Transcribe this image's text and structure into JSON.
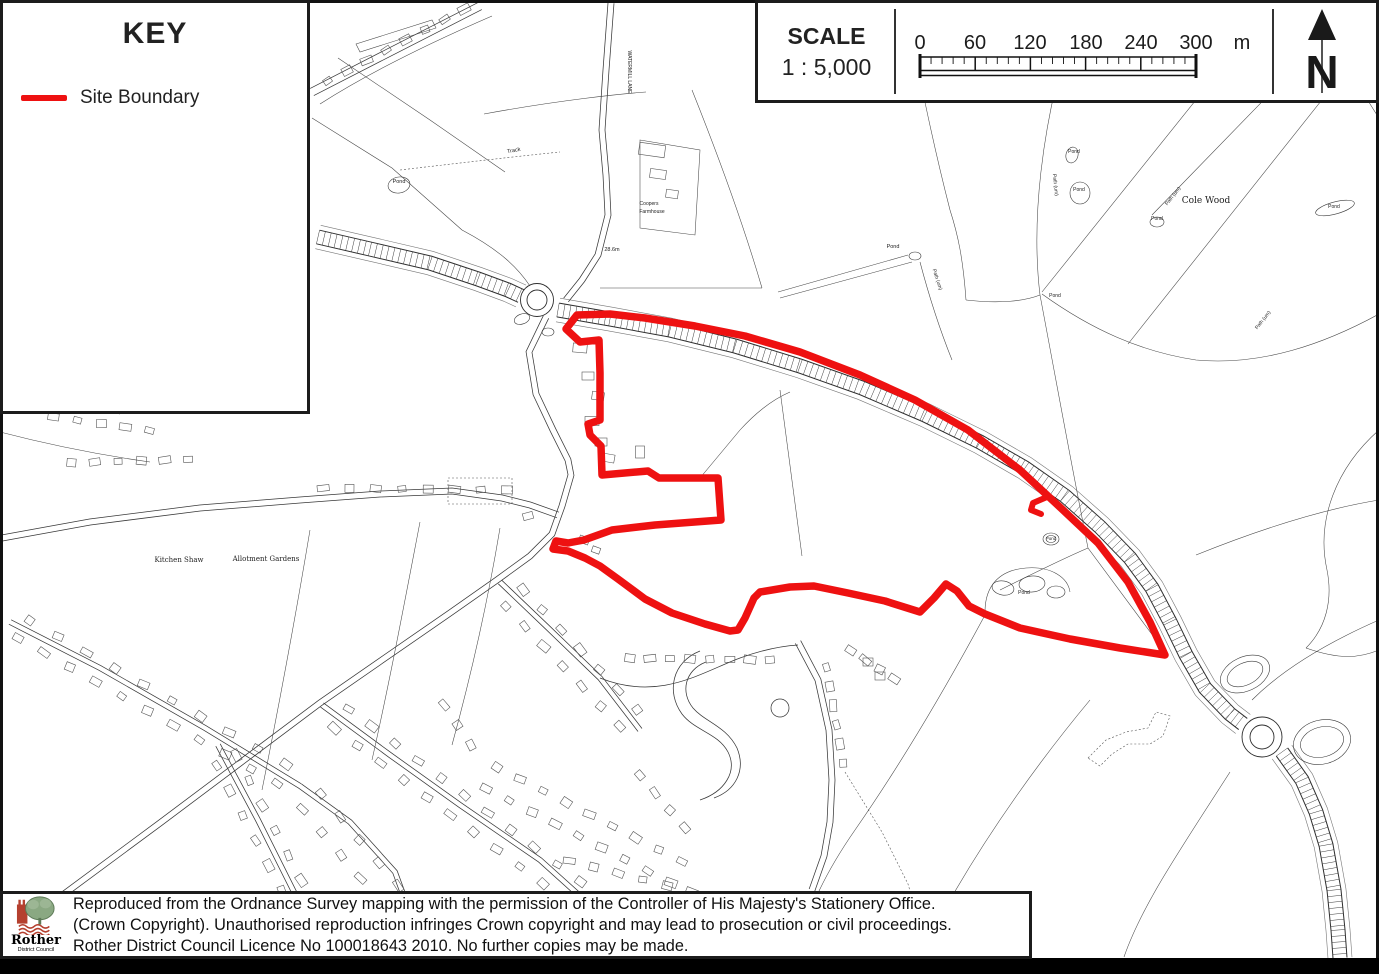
{
  "key_panel": {
    "title": "KEY",
    "item_label": "Site Boundary"
  },
  "scale_panel": {
    "title": "SCALE",
    "ratio": "1 : 5,000",
    "ticks": [
      "0",
      "60",
      "120",
      "180",
      "240",
      "300"
    ],
    "unit": "m"
  },
  "north_arrow": {
    "label": "N"
  },
  "colors": {
    "boundary": "#ee1111",
    "logo_red": "#b5402f",
    "logo_green": "#8aa882"
  },
  "site_boundary": {
    "points": [
      [
        577,
        315
      ],
      [
        566,
        329
      ],
      [
        580,
        342
      ],
      [
        599,
        340
      ],
      [
        600,
        373
      ],
      [
        600,
        420
      ],
      [
        588,
        424
      ],
      [
        590,
        435
      ],
      [
        601,
        446
      ],
      [
        602,
        475
      ],
      [
        648,
        471
      ],
      [
        659,
        478
      ],
      [
        718,
        478
      ],
      [
        721,
        520
      ],
      [
        655,
        525
      ],
      [
        612,
        530
      ],
      [
        584,
        540
      ],
      [
        568,
        543
      ],
      [
        556,
        541
      ],
      [
        553,
        549
      ],
      [
        568,
        551
      ],
      [
        585,
        558
      ],
      [
        600,
        566
      ],
      [
        618,
        579
      ],
      [
        645,
        599
      ],
      [
        672,
        613
      ],
      [
        705,
        624
      ],
      [
        730,
        631
      ],
      [
        738,
        630
      ],
      [
        745,
        618
      ],
      [
        754,
        598
      ],
      [
        760,
        592
      ],
      [
        790,
        587
      ],
      [
        814,
        586
      ],
      [
        848,
        593
      ],
      [
        885,
        601
      ],
      [
        920,
        612
      ],
      [
        934,
        598
      ],
      [
        946,
        584
      ],
      [
        957,
        591
      ],
      [
        969,
        606
      ],
      [
        985,
        614
      ],
      [
        1020,
        628
      ],
      [
        1070,
        639
      ],
      [
        1120,
        648
      ],
      [
        1165,
        655
      ],
      [
        1150,
        622
      ],
      [
        1128,
        582
      ],
      [
        1098,
        543
      ],
      [
        1063,
        510
      ],
      [
        1020,
        470
      ],
      [
        968,
        430
      ],
      [
        915,
        400
      ],
      [
        860,
        375
      ],
      [
        800,
        352
      ],
      [
        745,
        336
      ],
      [
        695,
        326
      ],
      [
        645,
        318
      ],
      [
        610,
        314
      ]
    ],
    "spur": [
      [
        1047,
        497
      ],
      [
        1033,
        503
      ],
      [
        1031,
        510
      ],
      [
        1041,
        514
      ]
    ]
  },
  "map_labels": [
    {
      "t": "Pond",
      "x": 399,
      "y": 183,
      "s": 5.5
    },
    {
      "t": "Track",
      "x": 514,
      "y": 152,
      "r": -10,
      "s": 5.5
    },
    {
      "t": "WATERMILL LANE",
      "x": 628,
      "y": 72,
      "r": 90,
      "s": 5
    },
    {
      "t": "28.6m",
      "x": 612,
      "y": 251,
      "s": 5.5
    },
    {
      "t": "Coopers",
      "x": 649,
      "y": 205,
      "s": 5
    },
    {
      "t": "Farmhouse",
      "x": 652,
      "y": 213,
      "s": 5
    },
    {
      "t": "Pond",
      "x": 893,
      "y": 248,
      "s": 5.5
    },
    {
      "t": "Path (um)",
      "x": 936,
      "y": 280,
      "r": 72,
      "s": 5
    },
    {
      "t": "Pond",
      "x": 1055,
      "y": 297,
      "s": 5
    },
    {
      "t": "Path (um)",
      "x": 1054,
      "y": 185,
      "r": 84,
      "s": 5
    },
    {
      "t": "Pond",
      "x": 1074,
      "y": 153,
      "s": 5
    },
    {
      "t": "Pond",
      "x": 1079,
      "y": 191,
      "s": 5
    },
    {
      "t": "Pond",
      "x": 1157,
      "y": 220,
      "s": 5
    },
    {
      "t": "Cole Wood",
      "x": 1206,
      "y": 203,
      "s": 9,
      "f": 1
    },
    {
      "t": "Pond",
      "x": 1334,
      "y": 208,
      "s": 5
    },
    {
      "t": "Path (um)",
      "x": 1174,
      "y": 197,
      "r": -52,
      "s": 5
    },
    {
      "t": "Path (um)",
      "x": 1264,
      "y": 321,
      "r": -52,
      "s": 5
    },
    {
      "t": "Kitchen Shaw",
      "x": 179,
      "y": 562,
      "s": 7,
      "f": 1
    },
    {
      "t": "Allotment Gardens",
      "x": 266,
      "y": 561,
      "s": 7,
      "f": 1
    },
    {
      "t": "Pond",
      "x": 1024,
      "y": 594,
      "s": 5
    },
    {
      "t": "Pond",
      "x": 1051,
      "y": 540,
      "s": 4.5
    }
  ],
  "copyright": {
    "lines": [
      "Reproduced from the Ordnance Survey mapping with the permission of the Controller of His Majesty's Stationery Office.",
      "(Crown Copyright). Unauthorised reproduction infringes Crown copyright and may lead to prosecution or civil proceedings.",
      "Rother District Council Licence No 100018643 2010. No further copies may be made."
    ],
    "logo_title": "Rother",
    "logo_subtitle": "District Council"
  }
}
